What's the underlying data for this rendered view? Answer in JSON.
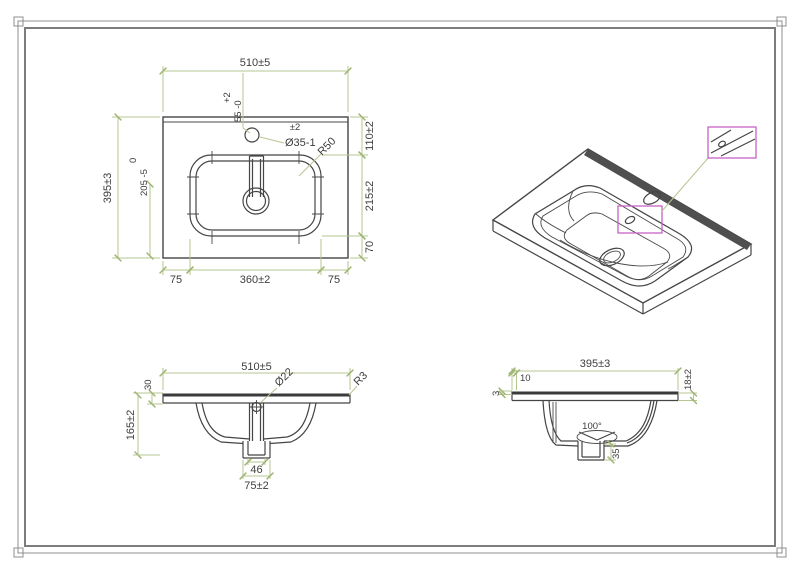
{
  "drawing": {
    "type": "technical-drawing",
    "subject": "vanity washbasin with overflow detail",
    "colors": {
      "line": "#454545",
      "dimension": "#b6c690",
      "text": "#3d3d3d",
      "highlight": "#c763c7",
      "background": "#ffffff"
    }
  },
  "plan": {
    "overall_width": "510±5",
    "tap_hole_offset": "55 -0",
    "tap_hole_offset_upper_tol": "+2",
    "overall_depth": "395±3",
    "basin_zero_tol": "0",
    "basin_offset": "205 -5",
    "tap_hole_tol": "±2",
    "tap_hole_dia": "Ø35-1",
    "basin_corner_radius": "R50",
    "back_ledge": "110±2",
    "basin_depth": "215±2",
    "front_ledge": "70",
    "side_margin_left": "75",
    "basin_width": "360±2",
    "side_margin_right": "75"
  },
  "front": {
    "overall_width": "510±5",
    "apron_height": "30",
    "overall_height": "165±2",
    "overflow_dia": "Ø22",
    "edge_radius": "R3",
    "drain_inner_width": "46",
    "drain_outer_width": "75±2"
  },
  "side": {
    "overall_depth": "395±3",
    "back_offset": "10",
    "rim_thickness": "3",
    "edge_thickness": "18±2",
    "drain_cone_angle": "100°",
    "drain_height": "35"
  }
}
